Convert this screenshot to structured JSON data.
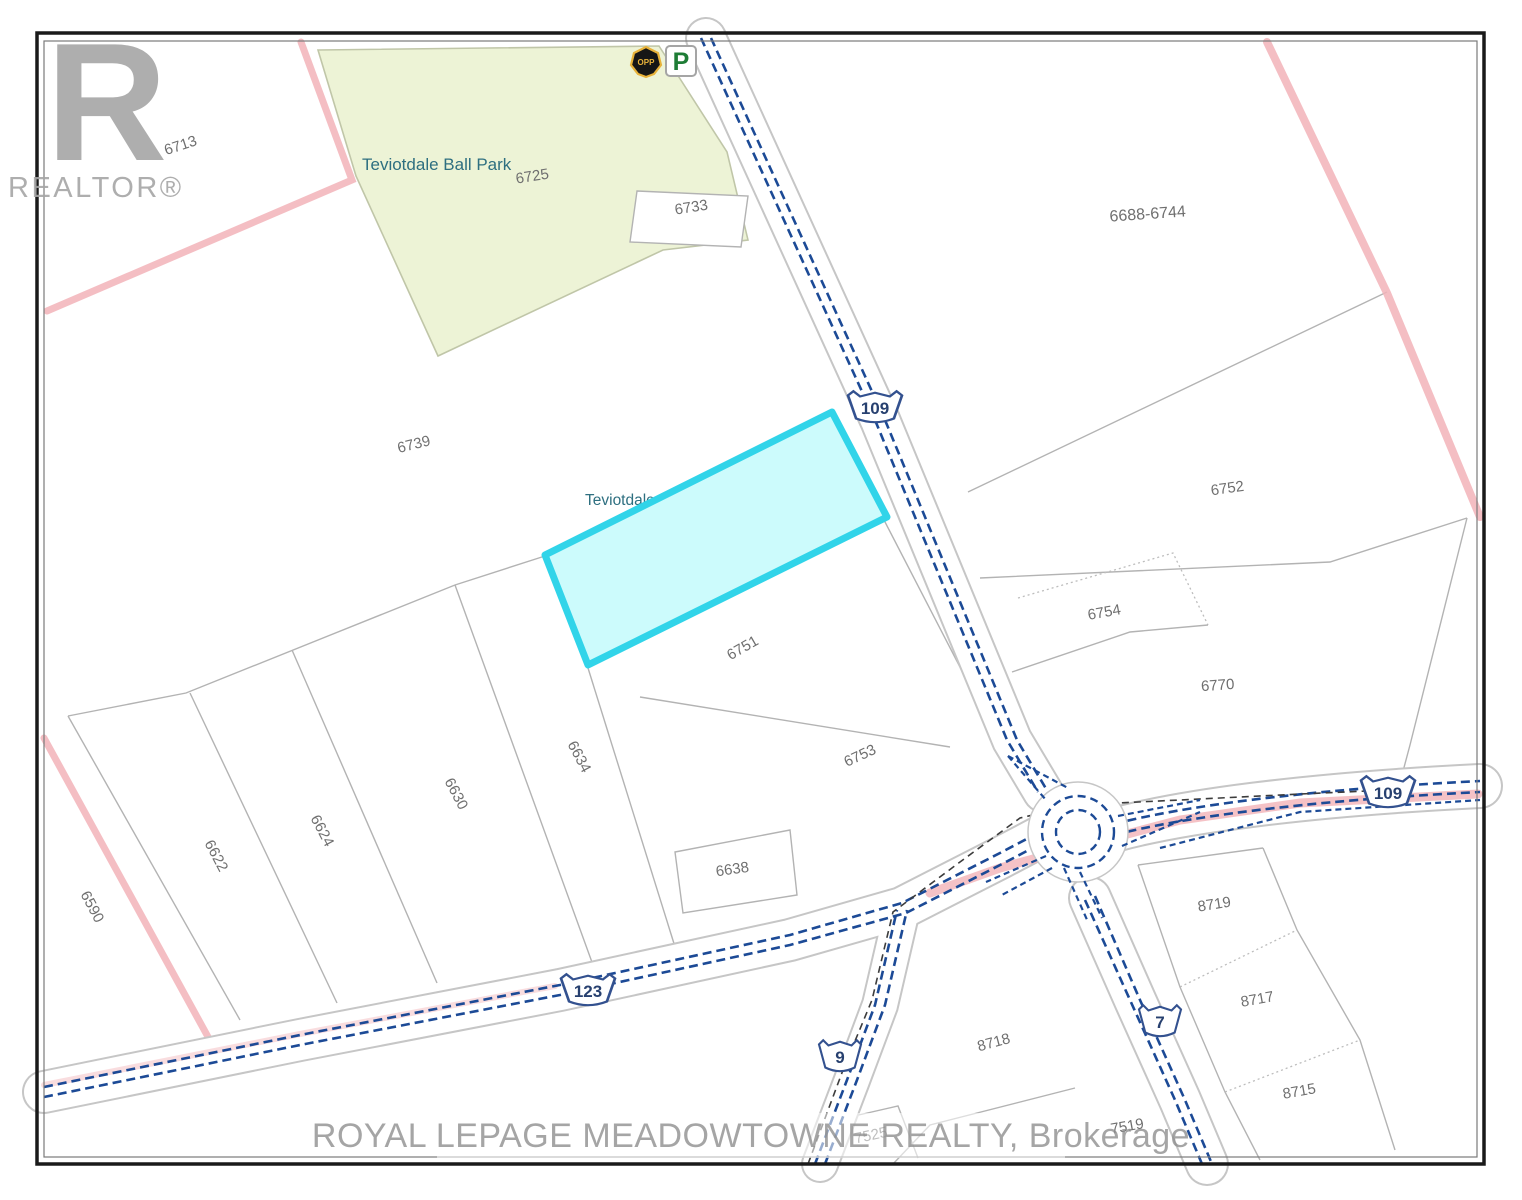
{
  "colors": {
    "road_blue": "#1c4a96",
    "pink_boundary": "#f2b3b8",
    "park_fill": "#edf3d6",
    "highlight_fill": "#c9fbfc",
    "highlight_stroke": "#31d4e9",
    "parcel_line": "#b3b3b3",
    "parcel_label_gray": "#6f6f6f",
    "place_label_teal": "#2e6f80",
    "watermark_gray": "#a6a6a6",
    "parking_green": "#1e7c35",
    "opp_gold": "#e8b23a"
  },
  "watermark_logo": {
    "letter": "R",
    "text": "REALTOR®"
  },
  "watermark_bottom": "ROYAL LEPAGE MEADOWTOWNE REALTY, Brokerage",
  "place_labels": [
    {
      "text": "Teviotdale Ball Park",
      "x": 362,
      "y": 170,
      "rot": 0,
      "size": 17,
      "under": false
    },
    {
      "text": "Teviotdale",
      "x": 585,
      "y": 505,
      "rot": 0,
      "size": 15.5,
      "under": true
    }
  ],
  "parcel_labels": [
    {
      "text": "6713",
      "x": 182,
      "y": 150,
      "rot": -18
    },
    {
      "text": "6725",
      "x": 533,
      "y": 181,
      "rot": -9
    },
    {
      "text": "6733",
      "x": 692,
      "y": 212,
      "rot": -9
    },
    {
      "text": "6739",
      "x": 415,
      "y": 449,
      "rot": -14
    },
    {
      "text": "6751",
      "x": 745,
      "y": 652,
      "rot": -30
    },
    {
      "text": "6753",
      "x": 862,
      "y": 760,
      "rot": -25
    },
    {
      "text": "6688-6744",
      "x": 1148,
      "y": 219,
      "rot": -4,
      "size": 16
    },
    {
      "text": "6752",
      "x": 1228,
      "y": 493,
      "rot": -8
    },
    {
      "text": "6754",
      "x": 1105,
      "y": 617,
      "rot": -10
    },
    {
      "text": "6770",
      "x": 1218,
      "y": 690,
      "rot": -4
    },
    {
      "text": "6590",
      "x": 88,
      "y": 909,
      "rot": 62
    },
    {
      "text": "6622",
      "x": 212,
      "y": 858,
      "rot": 62
    },
    {
      "text": "6624",
      "x": 318,
      "y": 833,
      "rot": 62
    },
    {
      "text": "6630",
      "x": 452,
      "y": 796,
      "rot": 62
    },
    {
      "text": "6634",
      "x": 575,
      "y": 759,
      "rot": 62
    },
    {
      "text": "6638",
      "x": 733,
      "y": 874,
      "rot": -8
    },
    {
      "text": "8719",
      "x": 1215,
      "y": 909,
      "rot": -9
    },
    {
      "text": "8717",
      "x": 1258,
      "y": 1004,
      "rot": -10
    },
    {
      "text": "8715",
      "x": 1300,
      "y": 1096,
      "rot": -10
    },
    {
      "text": "7519",
      "x": 1128,
      "y": 1131,
      "rot": -10
    },
    {
      "text": "8718",
      "x": 995,
      "y": 1047,
      "rot": -15
    },
    {
      "text": "7525",
      "x": 872,
      "y": 1140,
      "rot": -12
    }
  ],
  "highway_shields": [
    {
      "route": "109",
      "x": 875,
      "y": 408,
      "wide": true
    },
    {
      "route": "109",
      "x": 1388,
      "y": 793,
      "wide": true
    },
    {
      "route": "123",
      "x": 588,
      "y": 991,
      "wide": true
    },
    {
      "route": "9",
      "x": 840,
      "y": 1057,
      "wide": false
    },
    {
      "route": "7",
      "x": 1160,
      "y": 1022,
      "wide": false
    }
  ],
  "poi_icons": [
    {
      "name": "opp-badge-icon",
      "label": "OPP",
      "x": 646,
      "y": 62
    },
    {
      "name": "parking-icon",
      "label": "P",
      "x": 681,
      "y": 61
    }
  ]
}
